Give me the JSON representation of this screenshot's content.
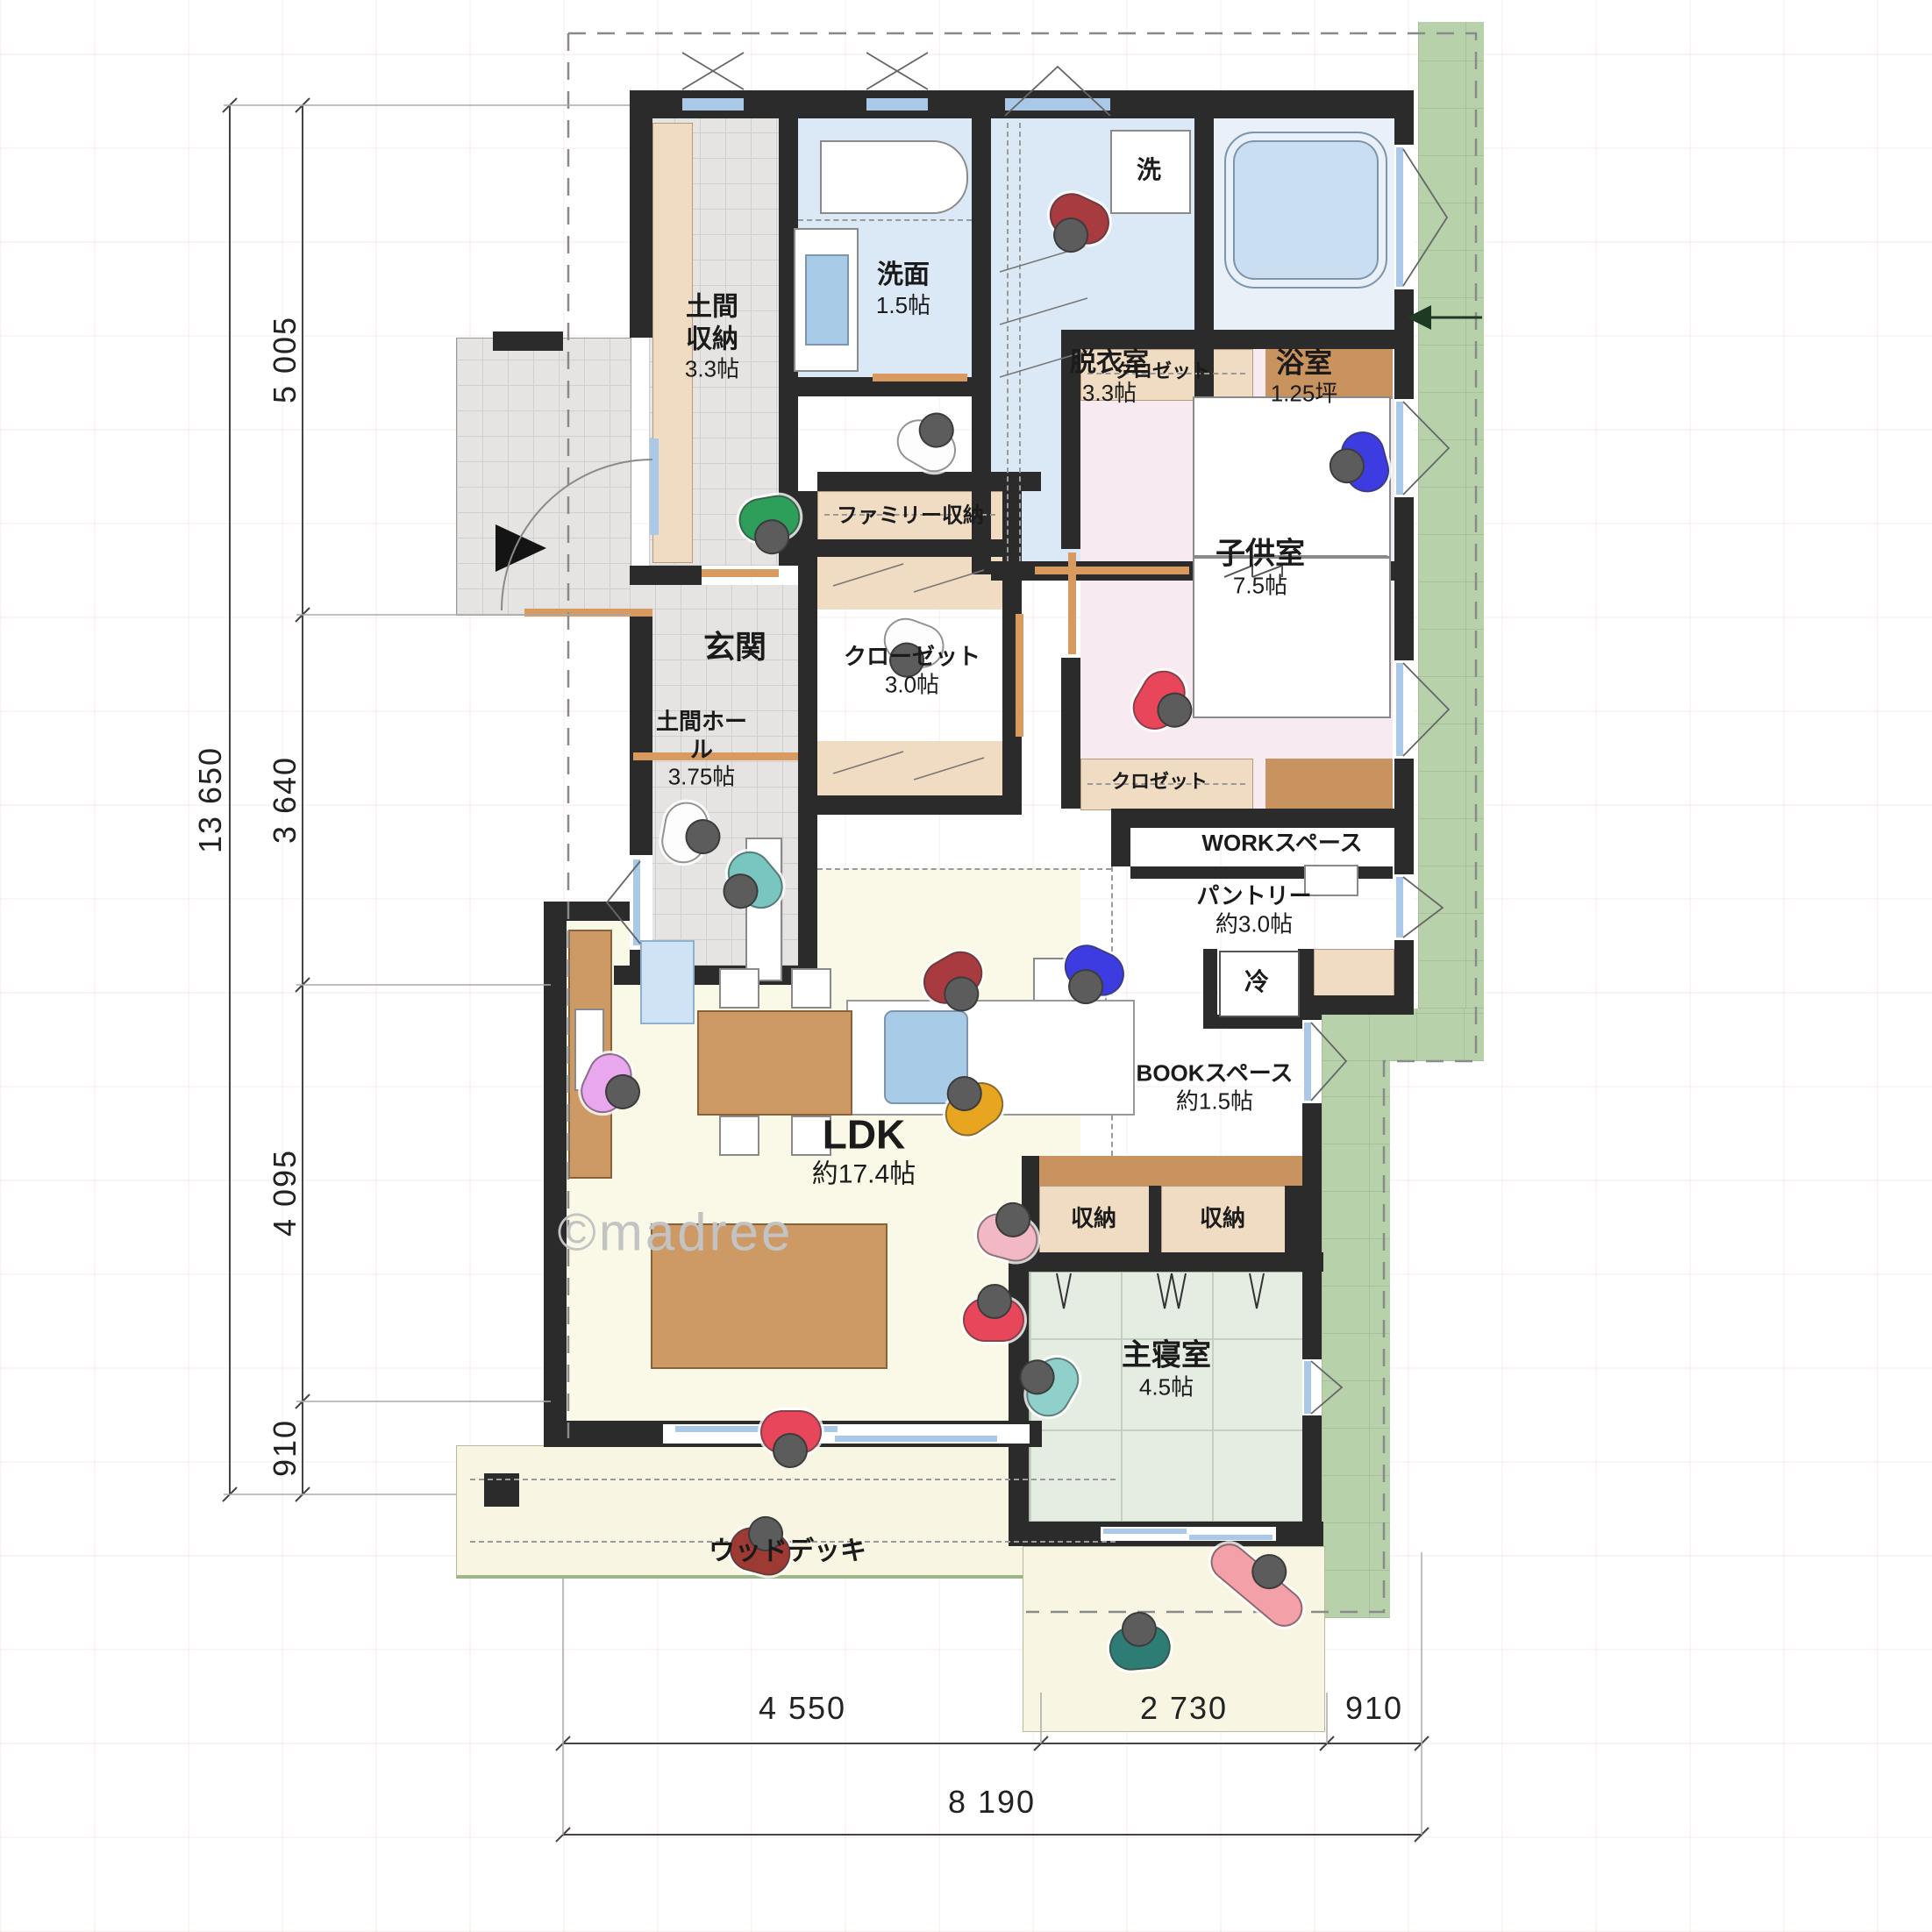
{
  "watermark": "©madree",
  "rooms": {
    "doma_storage": {
      "name": "土間収納",
      "size": "3.3帖"
    },
    "senmen": {
      "name": "洗面",
      "size": "1.5帖"
    },
    "datsui": {
      "name": "脱衣室",
      "size": "3.3帖"
    },
    "bath": {
      "name": "浴室",
      "size": "1.25坪"
    },
    "washer_label": "洗",
    "genkan": {
      "name": "玄関"
    },
    "family_storage": {
      "name": "ファミリー収納"
    },
    "closet": {
      "name": "クローゼット",
      "size": "3.0帖"
    },
    "doma_hall": {
      "name": "土間ホール",
      "size": "3.75帖"
    },
    "kids_room": {
      "name": "子供室",
      "size": "7.5帖"
    },
    "kids_closet_n": {
      "name": "クロゼット"
    },
    "kids_closet_s": {
      "name": "クロゼット"
    },
    "work_space": {
      "name": "WORKスペース"
    },
    "pantry": {
      "name": "パントリー",
      "size": "約3.0帖"
    },
    "fridge_label": "冷",
    "book_space": {
      "name": "BOOKスペース",
      "size": "約1.5帖"
    },
    "ldk": {
      "name": "LDK",
      "size": "約17.4帖"
    },
    "storage_w": {
      "name": "収納"
    },
    "storage_e": {
      "name": "収納"
    },
    "master": {
      "name": "主寝室",
      "size": "4.5帖"
    },
    "wood_deck": {
      "name": "ウッドデッキ"
    }
  },
  "dimensions": {
    "left": {
      "total": "13 650",
      "segments": [
        "5 005",
        "3 640",
        "4 095",
        "910"
      ]
    },
    "bottom": {
      "segments": [
        "4 550",
        "2 730",
        "910"
      ],
      "total": "8 190"
    }
  },
  "colors": {
    "wall": "#2b2b2b",
    "tile_gray": "#e5e4e2",
    "water_blue": "#dbe9f6",
    "bath_floor": "#e9f0f8",
    "tub_blue": "#c9def1",
    "kids_pink": "#f7eaf0",
    "ldk_cream": "#faf8e6",
    "tatami_green": "#e5ede3",
    "closet_beige": "#efdcc3",
    "wood_brown": "#cd9a66",
    "garden_green": "#b7d2aa",
    "window_blue": "#aac9e8",
    "door_orange": "#d89a5e"
  }
}
